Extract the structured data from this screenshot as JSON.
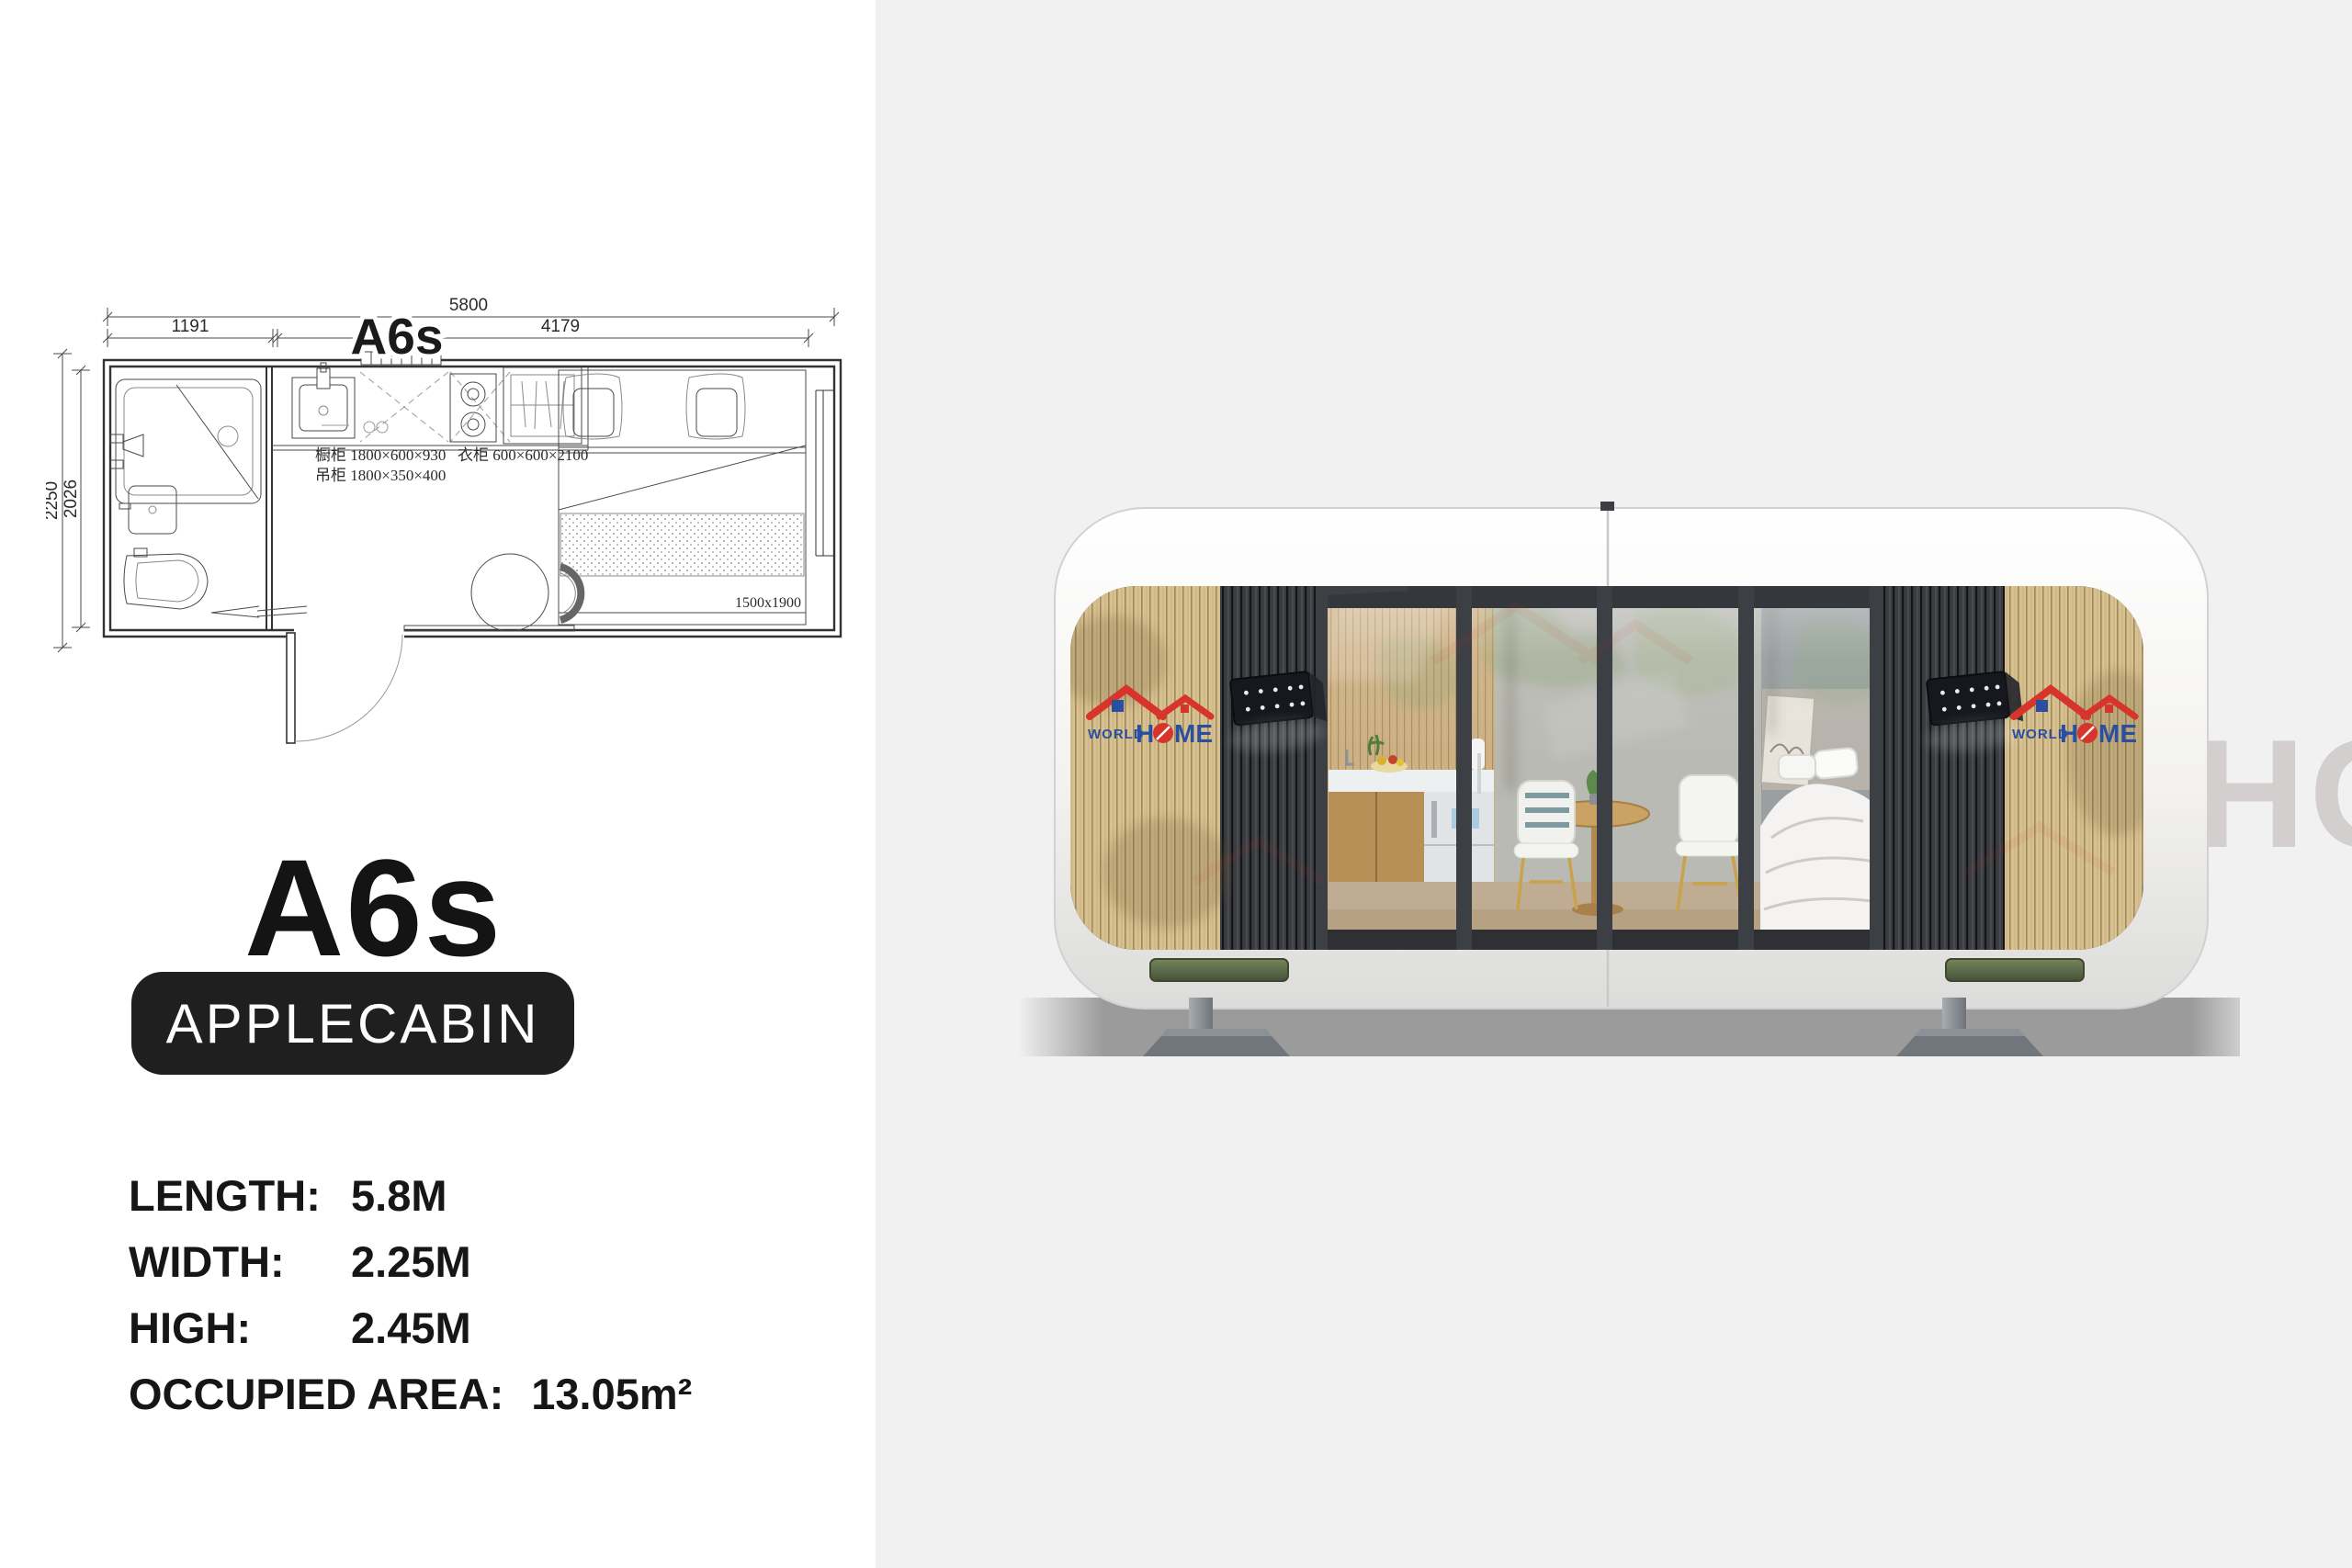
{
  "page": {
    "left_bg": "#ffffff",
    "right_bg": "#f1f1f2"
  },
  "floor_plan": {
    "model_label": "A6s",
    "dimensions": {
      "overall_length": "5800",
      "bathroom_length": "1191",
      "living_length": "4179",
      "overall_width": "2250",
      "inner_width": "2026",
      "bed_size": "1500x1900"
    },
    "annotations": {
      "kitchen_cabinet": "橱柜 1800×600×930",
      "hanging_cabinet": "吊柜 1800×350×400",
      "wardrobe": "衣柜 600×600×2100"
    }
  },
  "title": {
    "model": "A6s",
    "series_badge": "APPLECABIN"
  },
  "specs": {
    "items": [
      {
        "label": "LENGTH",
        "sep": ":",
        "value": "5.8M"
      },
      {
        "label": "WIDTH",
        "sep": ":",
        "value": "2.25M"
      },
      {
        "label": "HIGH",
        "sep": ":",
        "value": "2.45M"
      },
      {
        "label": "OCCUPIED AREA",
        "sep": ":",
        "value": "13.05m²"
      }
    ]
  },
  "render": {
    "brand": {
      "world": "WORLD",
      "h": "H",
      "me": "ME"
    },
    "watermark": "HOME",
    "colors": {
      "accent_red": "#d7342b",
      "accent_blue": "#2b4fa0",
      "wood": "#d8c191",
      "dark_slat": "#3a3c40",
      "shell": "#f6f5f3",
      "skid_green": "#5d6b48",
      "shadow": "#9b9b9b"
    }
  }
}
